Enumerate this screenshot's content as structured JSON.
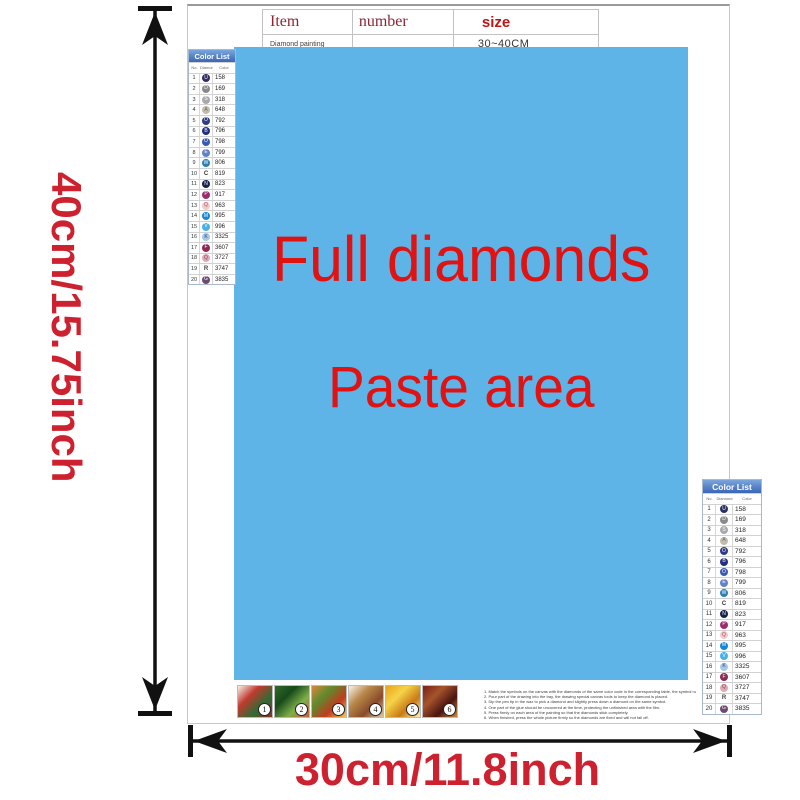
{
  "colors": {
    "paste_area_bg": "#5eb3e7",
    "paste_text_red": "#e01212",
    "dimension_red": "#ce2130",
    "table_header_red": "#8e2433",
    "size_red": "#c01515",
    "color_list_header_blue": "#3a67b5",
    "arrow_black": "#111111"
  },
  "dimensions": {
    "height_label": "40cm/15.75inch",
    "width_label": "30cm/11.8inch"
  },
  "item_table": {
    "col_item": "Item",
    "col_number": "number",
    "col_size": "size",
    "product": "Diamond painting",
    "number_value": "",
    "size_value": "30~40CM"
  },
  "paste_area": {
    "line1": "Full diamonds",
    "line2": "Paste area"
  },
  "color_list": {
    "title": "Color List",
    "col_no": "No.",
    "col_diamond": "Diamond",
    "col_color": "Color",
    "rows": [
      {
        "no": "1",
        "letter": "U",
        "bg": "#2c3063",
        "fg": "#ffffff",
        "flat": false,
        "code": "158"
      },
      {
        "no": "2",
        "letter": "D",
        "bg": "#8a8a8a",
        "fg": "#ffffff",
        "flat": false,
        "code": "169"
      },
      {
        "no": "3",
        "letter": "S",
        "bg": "#a9a9ab",
        "fg": "#ffffff",
        "flat": false,
        "code": "318"
      },
      {
        "no": "4",
        "letter": "A",
        "bg": "#c2bcae",
        "fg": "#6a6a5a",
        "flat": false,
        "code": "648"
      },
      {
        "no": "5",
        "letter": "O",
        "bg": "#2f3b85",
        "fg": "#ffffff",
        "flat": false,
        "code": "792"
      },
      {
        "no": "6",
        "letter": "B",
        "bg": "#222e7e",
        "fg": "#ffffff",
        "flat": false,
        "code": "796"
      },
      {
        "no": "7",
        "letter": "O",
        "bg": "#3a5ab0",
        "fg": "#ffffff",
        "flat": false,
        "code": "798"
      },
      {
        "no": "8",
        "letter": "E",
        "bg": "#5f83c4",
        "fg": "#ffffff",
        "flat": false,
        "code": "799"
      },
      {
        "no": "9",
        "letter": "W",
        "bg": "#2e7fb5",
        "fg": "#ffffff",
        "flat": false,
        "code": "806"
      },
      {
        "no": "10",
        "letter": "C",
        "bg": "",
        "fg": "#333333",
        "flat": true,
        "code": "819"
      },
      {
        "no": "11",
        "letter": "N",
        "bg": "#17224a",
        "fg": "#ffffff",
        "flat": false,
        "code": "823"
      },
      {
        "no": "12",
        "letter": "P",
        "bg": "#9b2d6f",
        "fg": "#ffffff",
        "flat": false,
        "code": "917"
      },
      {
        "no": "13",
        "letter": "Q",
        "bg": "#f3c9cc",
        "fg": "#8a5a5e",
        "flat": false,
        "code": "963"
      },
      {
        "no": "14",
        "letter": "M",
        "bg": "#1787d2",
        "fg": "#ffffff",
        "flat": false,
        "code": "995"
      },
      {
        "no": "15",
        "letter": "V",
        "bg": "#49b0e6",
        "fg": "#ffffff",
        "flat": false,
        "code": "996"
      },
      {
        "no": "16",
        "letter": "K",
        "bg": "#a8c8e6",
        "fg": "#2a4a7a",
        "flat": false,
        "code": "3325"
      },
      {
        "no": "17",
        "letter": "F",
        "bg": "#8d2a52",
        "fg": "#ffffff",
        "flat": false,
        "code": "3607"
      },
      {
        "no": "18",
        "letter": "Q",
        "bg": "#e0aab6",
        "fg": "#7a4a55",
        "flat": false,
        "code": "3727"
      },
      {
        "no": "19",
        "letter": "R",
        "bg": "",
        "fg": "#444444",
        "flat": true,
        "code": "3747"
      },
      {
        "no": "20",
        "letter": "G",
        "bg": "#6d4b70",
        "fg": "#ffffff",
        "flat": false,
        "code": "3835"
      }
    ]
  },
  "footer": {
    "thumbnails": [
      {
        "number": "1",
        "colors": [
          "#f5f2ea",
          "#c03a2e",
          "#2f6b34",
          "#8e2f22"
        ]
      },
      {
        "number": "2",
        "colors": [
          "#2e6b2c",
          "#174a1a",
          "#7fae4a",
          "#c75c3a"
        ]
      },
      {
        "number": "3",
        "colors": [
          "#d9893b",
          "#5f8a2e",
          "#c23a1e",
          "#f2c94c"
        ]
      },
      {
        "number": "4",
        "colors": [
          "#f7f3ec",
          "#b98a4a",
          "#8a4a2a",
          "#d9c9a8"
        ]
      },
      {
        "number": "5",
        "colors": [
          "#e8a41a",
          "#f6d34a",
          "#c97a14",
          "#fff2b0"
        ]
      },
      {
        "number": "6",
        "colors": [
          "#7a2016",
          "#a5542b",
          "#4a1410",
          "#c98a3a"
        ]
      }
    ],
    "instructions": [
      "1. Match the symbols on the canvas with the diamonds of the same color code in the corresponding table, the symbol number on the canvas.",
      "2. Pour part of the drawing into the tray, the drawing special canvas tools to keep the diamond is placed.",
      "3. Dip the pen tip in the wax to pick a diamond and slightly press down a diamond on the same symbol.",
      "4. One part of the glue should be uncovered at the time, protecting the unfinished area with the film.",
      "5. Press firmly on each area of the painting so that the diamonds stick completely.",
      "6. When finished, press the whole picture firmly so the diamonds are fixed and will not fall off."
    ]
  }
}
